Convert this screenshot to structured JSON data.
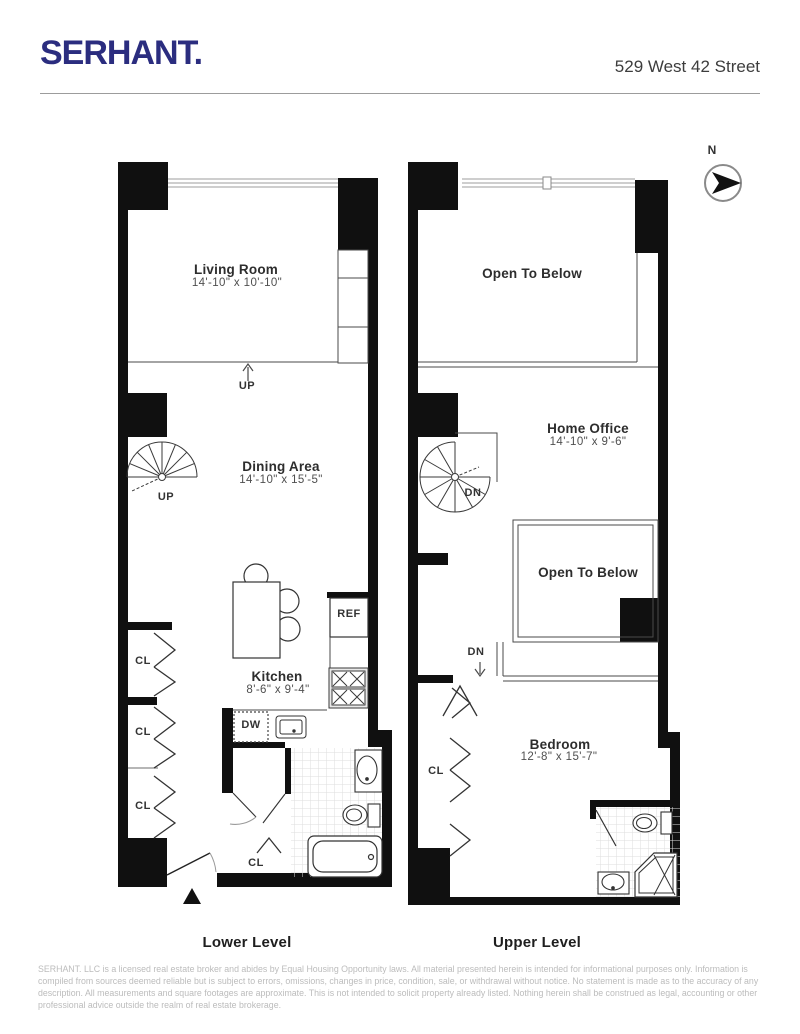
{
  "header": {
    "logo": "SERHANT.",
    "address": "529 West 42 Street"
  },
  "compass": {
    "north": "N"
  },
  "lower": {
    "caption": "Lower Level",
    "living_name": "Living Room",
    "living_dims": "14'-10\" x 10'-10\"",
    "dining_name": "Dining Area",
    "dining_dims": "14'-10\" x 15'-5\"",
    "kitchen_name": "Kitchen",
    "kitchen_dims": "8'-6\" x 9'-4\"",
    "up_step": "UP",
    "up_stairs": "UP",
    "ref": "REF",
    "dw": "DW",
    "cl1": "CL",
    "cl2": "CL",
    "cl3": "CL",
    "cl4": "CL"
  },
  "upper": {
    "caption": "Upper Level",
    "open_below_top": "Open To Below",
    "office_name": "Home Office",
    "office_dims": "14'-10\" x 9'-6\"",
    "open_below_mid": "Open To Below",
    "bedroom_name": "Bedroom",
    "bedroom_dims": "12'-8\" x 15'-7\"",
    "dn_stairs": "DN",
    "dn_walk": "DN",
    "cl": "CL"
  },
  "footer": {
    "disclaimer": "SERHANT. LLC is a licensed real estate broker and abides by Equal Housing Opportunity laws. All material presented herein is intended for informational purposes only. Information is compiled from sources deemed reliable but is subject to errors, omissions, changes in price, condition, sale, or withdrawal without notice. No statement is made as to the accuracy of any description. All measurements and square footages are approximate. This is not intended to solicit property already listed. Nothing herein shall be construed as legal, accounting or other professional advice outside the realm of real estate brokerage."
  },
  "colors": {
    "brand": "#2b2d7f",
    "wall": "#101010",
    "thin_line": "#4a4a4a",
    "window_line": "#b0b0b0",
    "text": "#2d2d2d",
    "muted": "#bcbcbc"
  }
}
